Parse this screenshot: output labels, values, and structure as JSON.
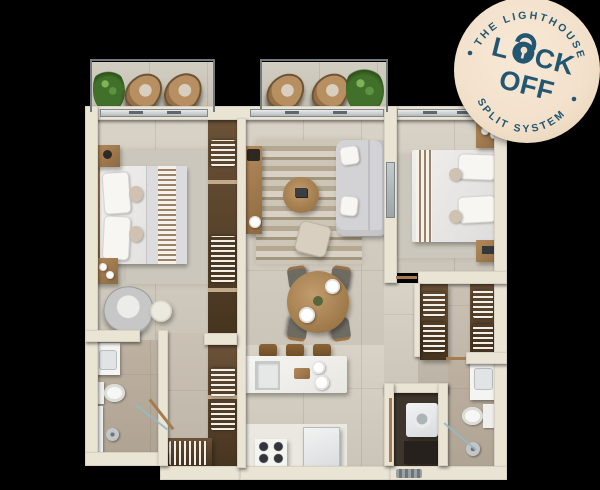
{
  "badge": {
    "top_text": "THE LIGHTHOUSE",
    "bottom_text": "SPLIT SYSTEM",
    "lock_pre": "L",
    "lock_post": "CK",
    "off_text": "OFF"
  },
  "palette": {
    "bg": "#000000",
    "wall": "#eae4d5",
    "floor_main": "#d6d0c3",
    "floor_balcony": "#cfcabd",
    "floor_bath": "#b9ac9c",
    "floor_closet": "#c7beb0",
    "floor_laundry": "#3e362c",
    "floor_white": "#eae8e1",
    "rug_light": "#cbc7bc",
    "wood": "#a57c50",
    "wood_dark": "#55422e",
    "sofa_gray": "#d3d3d5",
    "metal": "#8f969a",
    "green": "#447628",
    "navy": "#235671",
    "badge_bg": "#f2e0ca"
  },
  "floorplan": {
    "rooms": [
      "balcony-left",
      "balcony-living",
      "bedroom-1",
      "living-room",
      "dining-area",
      "bedroom-2",
      "kitchen",
      "bathroom-1",
      "bathroom-2",
      "walk-in-closet-left",
      "walk-in-closet-right",
      "laundry",
      "entry-hall"
    ],
    "furniture": [
      "double-bed",
      "nightstand",
      "table-lamp",
      "armchair",
      "side-table",
      "wardrobe",
      "tv-console",
      "sofa",
      "coffee-table",
      "ottoman",
      "striped-rug",
      "dining-table",
      "dining-chair",
      "plate",
      "kitchen-island",
      "island-sink",
      "bar-stool",
      "stove",
      "fridge",
      "bathroom-sink",
      "toilet",
      "shower",
      "washing-machine",
      "potted-plant",
      "wicker-chair",
      "entry-mat"
    ]
  }
}
